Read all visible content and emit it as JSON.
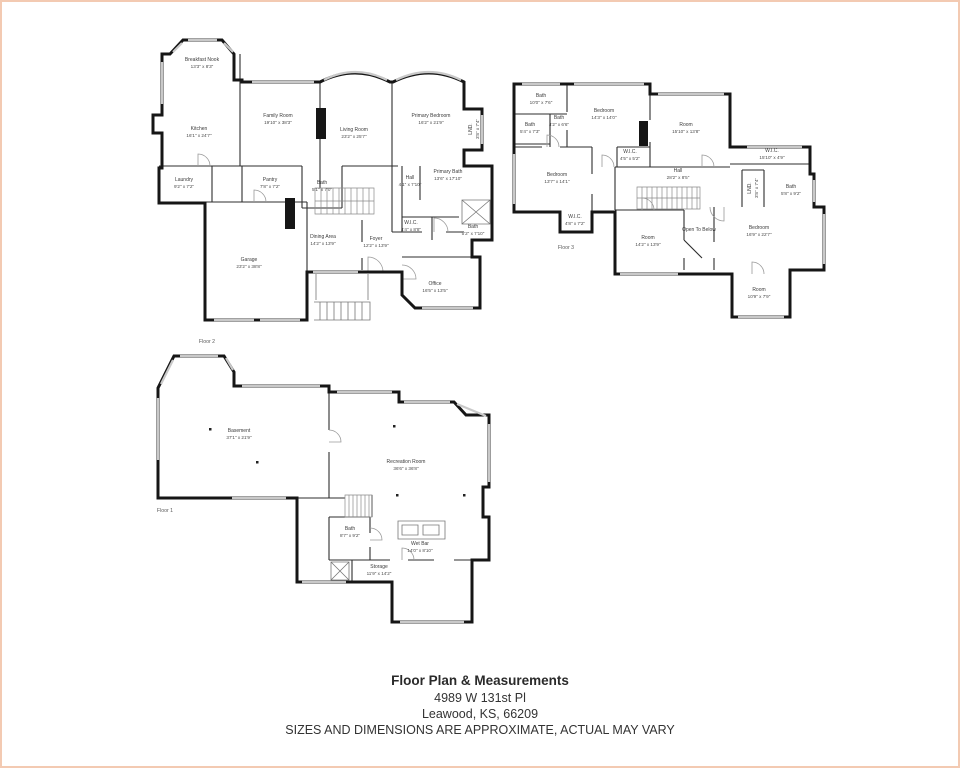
{
  "colors": {
    "walls": "#161616",
    "page_border": "#f3cab2",
    "background": "#ffffff",
    "window_lines": "#c9c9c9"
  },
  "footer": {
    "title": "Floor Plan & Measurements",
    "address_line1": "4989 W 131st Pl",
    "address_line2": "Leawood, KS, 66209",
    "disclaimer": "SIZES AND DIMENSIONS ARE APPROXIMATE, ACTUAL MAY VARY"
  },
  "floors": [
    {
      "id": "floor-2",
      "label": "Floor 2",
      "label_pos": {
        "x": 205,
        "y": 340
      },
      "rooms": [
        {
          "name": "Breakfast Nook",
          "dims": "13'3\" x 8'3\"",
          "x": 200,
          "y": 61
        },
        {
          "name": "Kitchen",
          "dims": "16'1\" x 24'7\"",
          "x": 197,
          "y": 130
        },
        {
          "name": "Family Room",
          "dims": "19'10\" x 38'3\"",
          "x": 276,
          "y": 117
        },
        {
          "name": "Living Room",
          "dims": "23'2\" x 25'7\"",
          "x": 352,
          "y": 131
        },
        {
          "name": "Primary Bedroom",
          "dims": "16'2\" x 21'9\"",
          "x": 429,
          "y": 117
        },
        {
          "name": "LND.",
          "dims": "3'8\" x 7'4\"",
          "x": 472,
          "y": 127,
          "vertical": true
        },
        {
          "name": "Laundry",
          "dims": "9'2\" x 7'2\"",
          "x": 182,
          "y": 181
        },
        {
          "name": "Pantry",
          "dims": "7'8\" x 7'2\"",
          "x": 268,
          "y": 181
        },
        {
          "name": "Bath",
          "dims": "5'1\" x 7'0\"",
          "x": 320,
          "y": 184
        },
        {
          "name": "Hall",
          "dims": "4'1\" x 7'10\"",
          "x": 408,
          "y": 179
        },
        {
          "name": "Primary Bath",
          "dims": "13'6\" x 17'10\"",
          "x": 446,
          "y": 173
        },
        {
          "name": "W.I.C.",
          "dims": "4'4\" x 8'8\"",
          "x": 409,
          "y": 224
        },
        {
          "name": "Bath",
          "dims": "5'2\" x 7'10\"",
          "x": 471,
          "y": 228
        },
        {
          "name": "Dining Area",
          "dims": "14'2\" x 13'9\"",
          "x": 321,
          "y": 238
        },
        {
          "name": "Foyer",
          "dims": "12'2\" x 13'9\"",
          "x": 374,
          "y": 240
        },
        {
          "name": "Garage",
          "dims": "23'2\" x 38'8\"",
          "x": 247,
          "y": 261
        },
        {
          "name": "Office",
          "dims": "16'5\" x 13'5\"",
          "x": 433,
          "y": 285
        }
      ]
    },
    {
      "id": "floor-3",
      "label": "Floor 3",
      "label_pos": {
        "x": 564,
        "y": 246
      },
      "rooms": [
        {
          "name": "Bath",
          "dims": "10'0\" x 7'6\"",
          "x": 539,
          "y": 97
        },
        {
          "name": "Bedroom",
          "dims": "14'3\" x 14'0\"",
          "x": 602,
          "y": 112
        },
        {
          "name": "Room",
          "dims": "15'10\" x 13'8\"",
          "x": 684,
          "y": 126
        },
        {
          "name": "Bath",
          "dims": "5'4\" x 7'3\"",
          "x": 528,
          "y": 126
        },
        {
          "name": "Bath",
          "dims": "4'2\" x 6'6\"",
          "x": 557,
          "y": 119
        },
        {
          "name": "W.I.C.",
          "dims": "4'5\" x 5'2\"",
          "x": 628,
          "y": 153
        },
        {
          "name": "W.I.C.",
          "dims": "15'10\" x 4'9\"",
          "x": 770,
          "y": 152
        },
        {
          "name": "Bedroom",
          "dims": "13'7\" x 14'1\"",
          "x": 555,
          "y": 176
        },
        {
          "name": "Hall",
          "dims": "28'2\" x 8'5\"",
          "x": 676,
          "y": 172
        },
        {
          "name": "LND.",
          "dims": "3'8\" x 7'4\"",
          "x": 751,
          "y": 186,
          "vertical": true
        },
        {
          "name": "Bath",
          "dims": "5'8\" x 9'2\"",
          "x": 789,
          "y": 188
        },
        {
          "name": "W.I.C.",
          "dims": "4'8\" x 7'2\"",
          "x": 573,
          "y": 218
        },
        {
          "name": "Room",
          "dims": "14'2\" x 13'9\"",
          "x": 646,
          "y": 239
        },
        {
          "name": "Open To Below",
          "dims": "",
          "x": 697,
          "y": 228
        },
        {
          "name": "Bedroom",
          "dims": "16'9\" x 22'7\"",
          "x": 757,
          "y": 229
        },
        {
          "name": "Room",
          "dims": "10'9\" x 7'9\"",
          "x": 757,
          "y": 291
        }
      ]
    },
    {
      "id": "floor-1",
      "label": "Floor 1",
      "label_pos": {
        "x": 163,
        "y": 509
      },
      "rooms": [
        {
          "name": "Basement",
          "dims": "37'1\" x 21'9\"",
          "x": 237,
          "y": 432
        },
        {
          "name": "Recreation Room",
          "dims": "36'6\" x 36'8\"",
          "x": 404,
          "y": 463
        },
        {
          "name": "Bath",
          "dims": "8'7\" x 9'2\"",
          "x": 348,
          "y": 530
        },
        {
          "name": "Wet Bar",
          "dims": "14'0\" x 8'10\"",
          "x": 418,
          "y": 545
        },
        {
          "name": "Storage",
          "dims": "11'9\" x 14'2\"",
          "x": 377,
          "y": 568
        }
      ]
    }
  ]
}
